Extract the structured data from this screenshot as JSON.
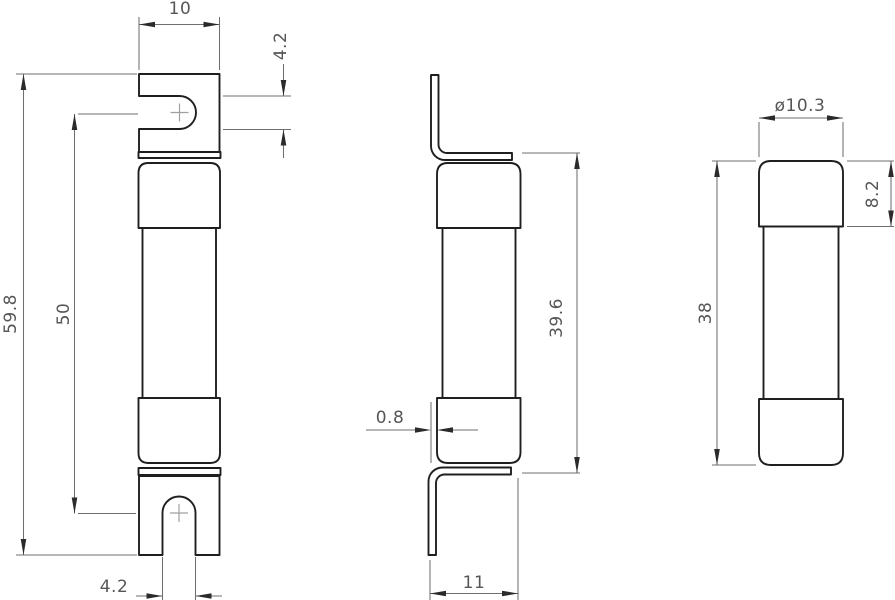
{
  "drawing": {
    "kind": "technical-drawing",
    "subject": "blade-contact cartridge fuse link, three orthographic views",
    "background_color": "#ffffff",
    "line_color": "#1f1f1f",
    "dimension_color": "#565656",
    "views": {
      "front": {
        "name": "front view",
        "labels": {
          "tab_width": "10",
          "slot_offset": "4.2",
          "overall_length": "59.8",
          "slot_centers_distance": "50",
          "slot_width": "4.2"
        }
      },
      "side": {
        "name": "side view",
        "labels": {
          "blade_thickness": "0.8",
          "length_with_blades": "39.6",
          "blade_depth": "11"
        }
      },
      "cartridge": {
        "name": "cartridge end view",
        "labels": {
          "diameter": "ø10.3",
          "cap_length": "8.2",
          "body_length": "38"
        }
      }
    }
  }
}
